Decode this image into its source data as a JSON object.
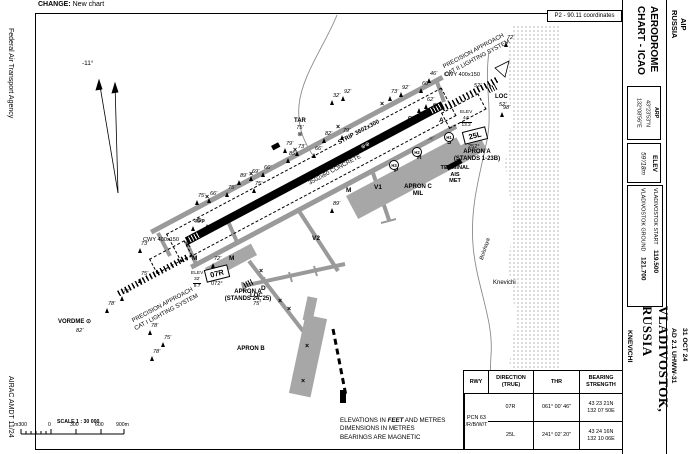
{
  "header": {
    "change_label": "CHANGE:",
    "change_value": "New chart"
  },
  "left_margin": {
    "agency": "Federal Air Transport Agency",
    "airac": "AIRAC AMDT 11/24"
  },
  "sidebar": {
    "aip": "AIP\nRUSSIA",
    "chart_title_line1": "AERODROME",
    "chart_title_line2": "CHART - ICAO",
    "arp_label": "ARP",
    "arp_lat": "43°23'53\"N",
    "arp_lon": "132°08'56\"E",
    "elev_label": "ELEV",
    "elev_value": "59'/18m",
    "freqs": [
      {
        "name": "VLADIVOSTOK START",
        "value": "119.500"
      },
      {
        "name": "VLADIVOSTOK GROUND",
        "value": "121.700"
      }
    ],
    "city": "VLADIVOSTOK, RUSSIA",
    "airport": "KNEVICHI",
    "date": "31 OCT 24",
    "ad_ref": "AD 2.1 UHWW-31"
  },
  "map": {
    "coords_note": "P2 - 90.11 coordinates",
    "variation": "-11°",
    "strip_label": "STRIP 3602x300",
    "runway_label": "3502x60 CONCRETE",
    "runway_symbols": "⊕⊕",
    "hold_symbol": "⊣⊢",
    "thr_07r": {
      "id": "07R",
      "mag": "072°",
      "elev_label": "ELEV",
      "elev_ft": "32'",
      "elev_m": "9.7",
      "cwy": "CWY\n400x150"
    },
    "thr_25l": {
      "id": "25L",
      "mag": "252°",
      "elev_label": "ELEV",
      "elev_ft": "44'",
      "elev_m": "13.2",
      "cwy": "CWY\n400x150",
      "cwy_elev": "52'"
    },
    "approach_07r": "PRECISION APPROACH\nCAT I LIGHTING SYSTEM",
    "approach_25l": "PRECISION APPROACH\nCAT II LIGHTING SYSTEM",
    "vordme_label": "VORDME ⊙",
    "vordme_elev": "82'",
    "loc_07r_label": "LOC",
    "loc_07r_elev": "75'",
    "loc_25l_label": "LOC",
    "loc_25l_elev": "52'",
    "tar_label": "TAR",
    "tar_elev": "75'",
    "tar_symbol": "⊗",
    "gp_07r": "Gp",
    "gp_25l": "GP",
    "apron_a_west": "APRON A\n(STANDS 24, 25)",
    "apron_a_east": "APRON A\n(STANDS 1-23B)",
    "apron_b": "APRON B",
    "apron_c": "APRON C\nMIL",
    "terminal": "TERMINAL\nAIS\nMET",
    "town": "Knevichi",
    "river": "Bolshaya",
    "taxiway_labels": [
      {
        "x": 186,
        "y": 243,
        "t": "K"
      },
      {
        "x": 192,
        "y": 256,
        "t": "M"
      },
      {
        "x": 229,
        "y": 256,
        "t": "M"
      },
      {
        "x": 346,
        "y": 188,
        "t": "M"
      },
      {
        "x": 374,
        "y": 185,
        "t": "V1"
      },
      {
        "x": 312,
        "y": 236,
        "t": "V2"
      },
      {
        "x": 261,
        "y": 286,
        "t": "D"
      },
      {
        "x": 394,
        "y": 168,
        "t": "P"
      },
      {
        "x": 417,
        "y": 155,
        "t": "R"
      },
      {
        "x": 447,
        "y": 140,
        "t": "S"
      },
      {
        "x": 433,
        "y": 104,
        "t": "F"
      },
      {
        "x": 439,
        "y": 118,
        "t": "A"
      }
    ],
    "hold_points": [
      {
        "x": 389,
        "y": 160,
        "t": "H3"
      },
      {
        "x": 412,
        "y": 147,
        "t": "H2"
      },
      {
        "x": 444,
        "y": 132,
        "t": "H1"
      }
    ],
    "closed_marks": [
      {
        "x": 205,
        "y": 194,
        "t": "×"
      },
      {
        "x": 249,
        "y": 171,
        "t": "×"
      },
      {
        "x": 293,
        "y": 147,
        "t": "×"
      },
      {
        "x": 336,
        "y": 124,
        "t": "×"
      },
      {
        "x": 380,
        "y": 101,
        "t": "×"
      },
      {
        "x": 259,
        "y": 268,
        "t": "×"
      },
      {
        "x": 278,
        "y": 298,
        "t": "×"
      },
      {
        "x": 305,
        "y": 343,
        "t": "×"
      },
      {
        "x": 301,
        "y": 378,
        "t": "×"
      },
      {
        "x": 287,
        "y": 306,
        "t": "×"
      }
    ],
    "obstacles": [
      {
        "x": 138,
        "y": 248,
        "h": "73'"
      },
      {
        "x": 211,
        "y": 263,
        "h": "72'"
      },
      {
        "x": 138,
        "y": 278,
        "h": "75'"
      },
      {
        "x": 120,
        "y": 296,
        "h": "75'"
      },
      {
        "x": 105,
        "y": 308,
        "h": "78'"
      },
      {
        "x": 148,
        "y": 330,
        "h": "78'"
      },
      {
        "x": 161,
        "y": 342,
        "h": "75'"
      },
      {
        "x": 150,
        "y": 356,
        "h": "78'"
      },
      {
        "x": 195,
        "y": 200,
        "h": "75'"
      },
      {
        "x": 207,
        "y": 198,
        "h": "66'"
      },
      {
        "x": 225,
        "y": 192,
        "h": "75'"
      },
      {
        "x": 237,
        "y": 180,
        "h": "89'"
      },
      {
        "x": 249,
        "y": 176,
        "h": "69'"
      },
      {
        "x": 261,
        "y": 172,
        "h": "66'"
      },
      {
        "x": 252,
        "y": 188,
        "h": "75'"
      },
      {
        "x": 283,
        "y": 148,
        "h": "79'"
      },
      {
        "x": 295,
        "y": 151,
        "h": "73'"
      },
      {
        "x": 286,
        "y": 158,
        "h": "85'"
      },
      {
        "x": 312,
        "y": 153,
        "h": "66'"
      },
      {
        "x": 322,
        "y": 138,
        "h": "82'"
      },
      {
        "x": 340,
        "y": 135,
        "h": "79'"
      },
      {
        "x": 330,
        "y": 100,
        "h": "32'"
      },
      {
        "x": 341,
        "y": 96,
        "h": "92'"
      },
      {
        "x": 388,
        "y": 96,
        "h": "73'"
      },
      {
        "x": 399,
        "y": 92,
        "h": "92'"
      },
      {
        "x": 419,
        "y": 88,
        "h": "66'"
      },
      {
        "x": 427,
        "y": 78,
        "h": "46'"
      },
      {
        "x": 330,
        "y": 208,
        "h": "89'"
      },
      {
        "x": 424,
        "y": 104,
        "h": "62'"
      },
      {
        "x": 191,
        "y": 226,
        "h": "46'"
      },
      {
        "x": 504,
        "y": 42,
        "h": "72'"
      },
      {
        "x": 500,
        "y": 112,
        "h": "98'"
      }
    ]
  },
  "footer": {
    "scale_label": "SCALE 1 : 30 000",
    "scale_ticks": [
      {
        "x": 14,
        "t": "m300"
      },
      {
        "x": 48,
        "t": "0"
      },
      {
        "x": 70,
        "t": "300"
      },
      {
        "x": 95,
        "t": "600"
      },
      {
        "x": 116,
        "t": "900m"
      }
    ],
    "note1a": "ELEVATIONS IN ",
    "note1b": "FEET",
    "note1c": " AND METRES",
    "note2": "DIMENSIONS IN METRES",
    "note3": "BEARINGS ARE MAGNETIC"
  },
  "table": {
    "headers": {
      "rwy": "RWY",
      "direction": "DIRECTION\n(TRUE)",
      "thr": "THR",
      "bearing": "BEARING\nSTRENGTH"
    },
    "rows": [
      {
        "rwy": "07R",
        "direction": "061° 00' 46\"",
        "thr": "43 23 21N\n132 07 50E"
      },
      {
        "rwy": "25L",
        "direction": "241° 02' 20\"",
        "thr": "43 24 16N\n132 10 06E"
      }
    ],
    "pcn": "PCN 63\n/R/B/W/T"
  }
}
